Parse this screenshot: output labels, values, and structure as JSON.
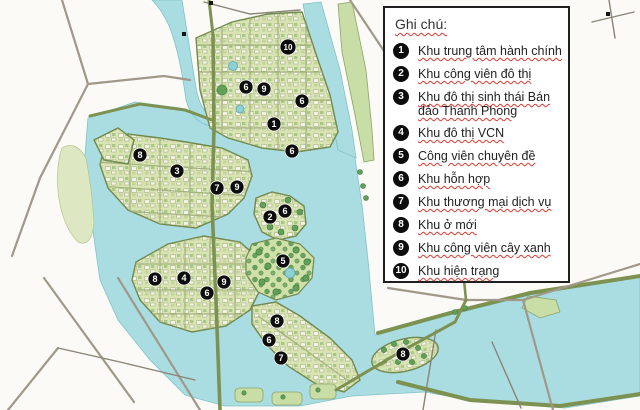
{
  "legend": {
    "title": "Ghi chú:",
    "items": [
      {
        "num": "1",
        "label": "Khu trung tâm hành chính"
      },
      {
        "num": "2",
        "label": "Khu công viên đô thị"
      },
      {
        "num": "3",
        "label": "Khu đô thị sinh thái Bán đảo Thanh Phong"
      },
      {
        "num": "4",
        "label": "Khu đô thị VCN"
      },
      {
        "num": "5",
        "label": "Công viên chuyên đề"
      },
      {
        "num": "6",
        "label": "Khu hỗn hợp"
      },
      {
        "num": "7",
        "label": "Khu thương mại dịch vụ"
      },
      {
        "num": "8",
        "label": "Khu ở mới"
      },
      {
        "num": "9",
        "label": "Khu công viên cây xanh"
      },
      {
        "num": "10",
        "label": "Khu hiện trạng"
      }
    ]
  },
  "map": {
    "markers": [
      {
        "num": "10",
        "x": 288,
        "y": 47
      },
      {
        "num": "6",
        "x": 246,
        "y": 87
      },
      {
        "num": "9",
        "x": 264,
        "y": 89
      },
      {
        "num": "6",
        "x": 302,
        "y": 101
      },
      {
        "num": "1",
        "x": 274,
        "y": 124
      },
      {
        "num": "6",
        "x": 292,
        "y": 151
      },
      {
        "num": "8",
        "x": 140,
        "y": 155
      },
      {
        "num": "3",
        "x": 177,
        "y": 171
      },
      {
        "num": "7",
        "x": 217,
        "y": 188
      },
      {
        "num": "9",
        "x": 237,
        "y": 187
      },
      {
        "num": "6",
        "x": 285,
        "y": 211
      },
      {
        "num": "2",
        "x": 270,
        "y": 217
      },
      {
        "num": "5",
        "x": 283,
        "y": 261
      },
      {
        "num": "8",
        "x": 155,
        "y": 279
      },
      {
        "num": "4",
        "x": 184,
        "y": 278
      },
      {
        "num": "9",
        "x": 224,
        "y": 282
      },
      {
        "num": "6",
        "x": 207,
        "y": 293
      },
      {
        "num": "8",
        "x": 277,
        "y": 321
      },
      {
        "num": "6",
        "x": 269,
        "y": 340
      },
      {
        "num": "7",
        "x": 281,
        "y": 358
      },
      {
        "num": "8",
        "x": 403,
        "y": 354
      }
    ],
    "colors": {
      "water": "#aadde2",
      "water_edge": "#7fc3c9",
      "land": "#d9e3b3",
      "district_edge": "#71894e",
      "tree": "#61a059",
      "road": "#a09889",
      "parkway": "#7d9150",
      "marker_bg": "#0d0d0d",
      "marker_text": "#ffffff",
      "spellcheck_underline": "#e0392f"
    }
  }
}
